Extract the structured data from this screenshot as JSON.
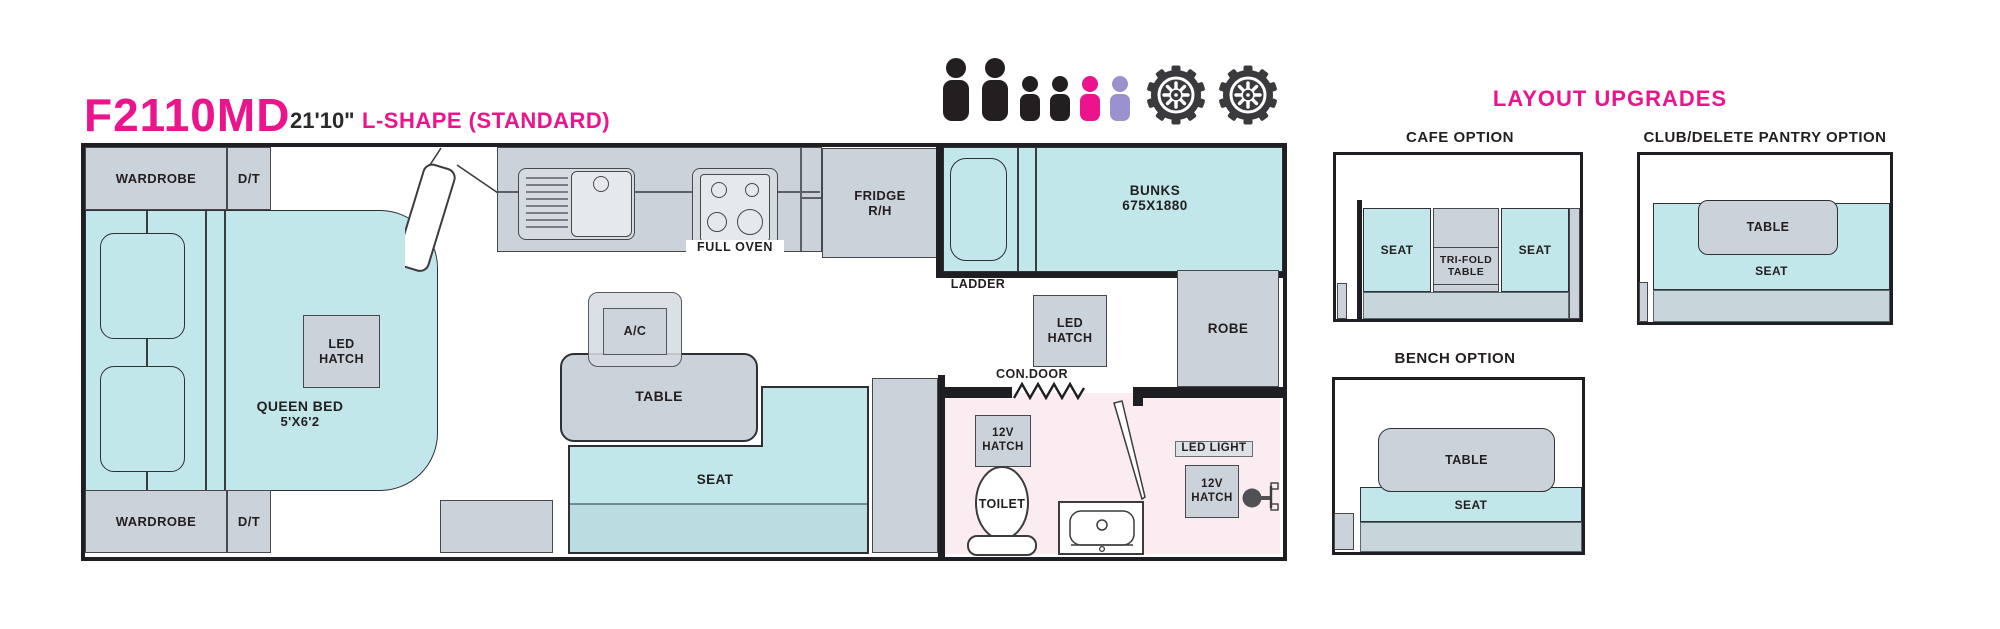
{
  "header": {
    "model": "F2110MD",
    "length": "21'10\"",
    "layout_name": "L-SHAPE (STANDARD)"
  },
  "capacity": {
    "people": [
      "adult-black",
      "adult-black",
      "child-black",
      "child-black",
      "child-pink",
      "child-purple"
    ],
    "wheel_count": 2
  },
  "colors": {
    "brand_pink": "#ec148c",
    "cyan": "#c2e7eb",
    "seat_base": "#b9dde1",
    "cabinet_gray": "#ccd2da",
    "bathroom_pink": "#fbecf2",
    "child_purple": "#9a92cf",
    "ink": "#231f20"
  },
  "plan": {
    "wardrobe_top": "WARDROBE",
    "dt_top": "D/T",
    "wardrobe_bottom": "WARDROBE",
    "dt_bottom": "D/T",
    "queen_bed_line1": "QUEEN BED",
    "queen_bed_line2": "5'X6'2",
    "led_hatch_bed": "LED HATCH",
    "ac": "A/C",
    "table": "TABLE",
    "seat": "SEAT",
    "full_oven": "FULL OVEN",
    "fridge_line1": "FRIDGE",
    "fridge_line2": "R/H",
    "ladder": "LADDER",
    "bunks_line1": "BUNKS",
    "bunks_line2": "675X1880",
    "robe": "ROBE",
    "led_hatch_hall": "LED HATCH",
    "con_door": "CON.DOOR",
    "hatch_12v_left": "12V HATCH",
    "toilet": "TOILET",
    "led_light": "LED LIGHT",
    "hatch_12v_right": "12V HATCH"
  },
  "upgrades": {
    "title": "LAYOUT UPGRADES",
    "cafe": {
      "heading": "CAFE OPTION",
      "seat_left": "SEAT",
      "tri_fold_table": "TRI-FOLD TABLE",
      "seat_right": "SEAT"
    },
    "club": {
      "heading": "CLUB/DELETE PANTRY OPTION",
      "table": "TABLE",
      "seat": "SEAT"
    },
    "bench": {
      "heading": "BENCH OPTION",
      "table": "TABLE",
      "seat": "SEAT"
    }
  }
}
